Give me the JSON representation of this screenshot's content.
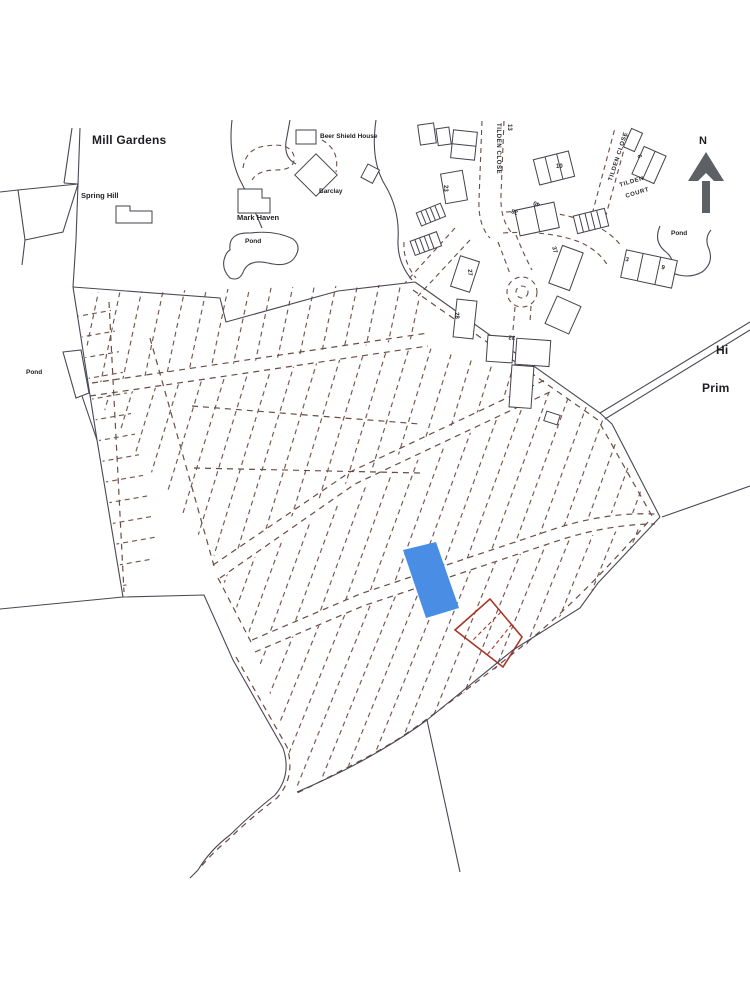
{
  "map": {
    "region_labels": {
      "mill_gardens": "Mill Gardens",
      "spring_hill": "Spring Hill",
      "beer_shield_house": "Beer Shield House",
      "barclay": "Barclay",
      "mark_haven": "Mark Haven",
      "pond_top": "Pond",
      "pond_left": "Pond",
      "pond_right": "Pond",
      "high_partial": "Hi",
      "primary_partial": "Prim"
    },
    "street_labels": {
      "tilden_close_vertical": "TILDEN CLOSE",
      "tilden_close_diagonal": "TILDEN CLOSE",
      "tilden_court_line1": "TILDEN",
      "tilden_court_line2": "COURT"
    },
    "compass_label": "N",
    "house_numbers": [
      "13",
      "10",
      "23",
      "38",
      "40",
      "37",
      "27",
      "28",
      "32",
      "6",
      "3",
      "9"
    ],
    "colors": {
      "selected_plot_blue": "#4a8de5",
      "outlined_plot_red": "#a93526",
      "plot_boundary_dashed": "#6b4c43",
      "field_boundary_solid": "#4b4754",
      "north_arrow_gray": "#5d6065"
    }
  }
}
